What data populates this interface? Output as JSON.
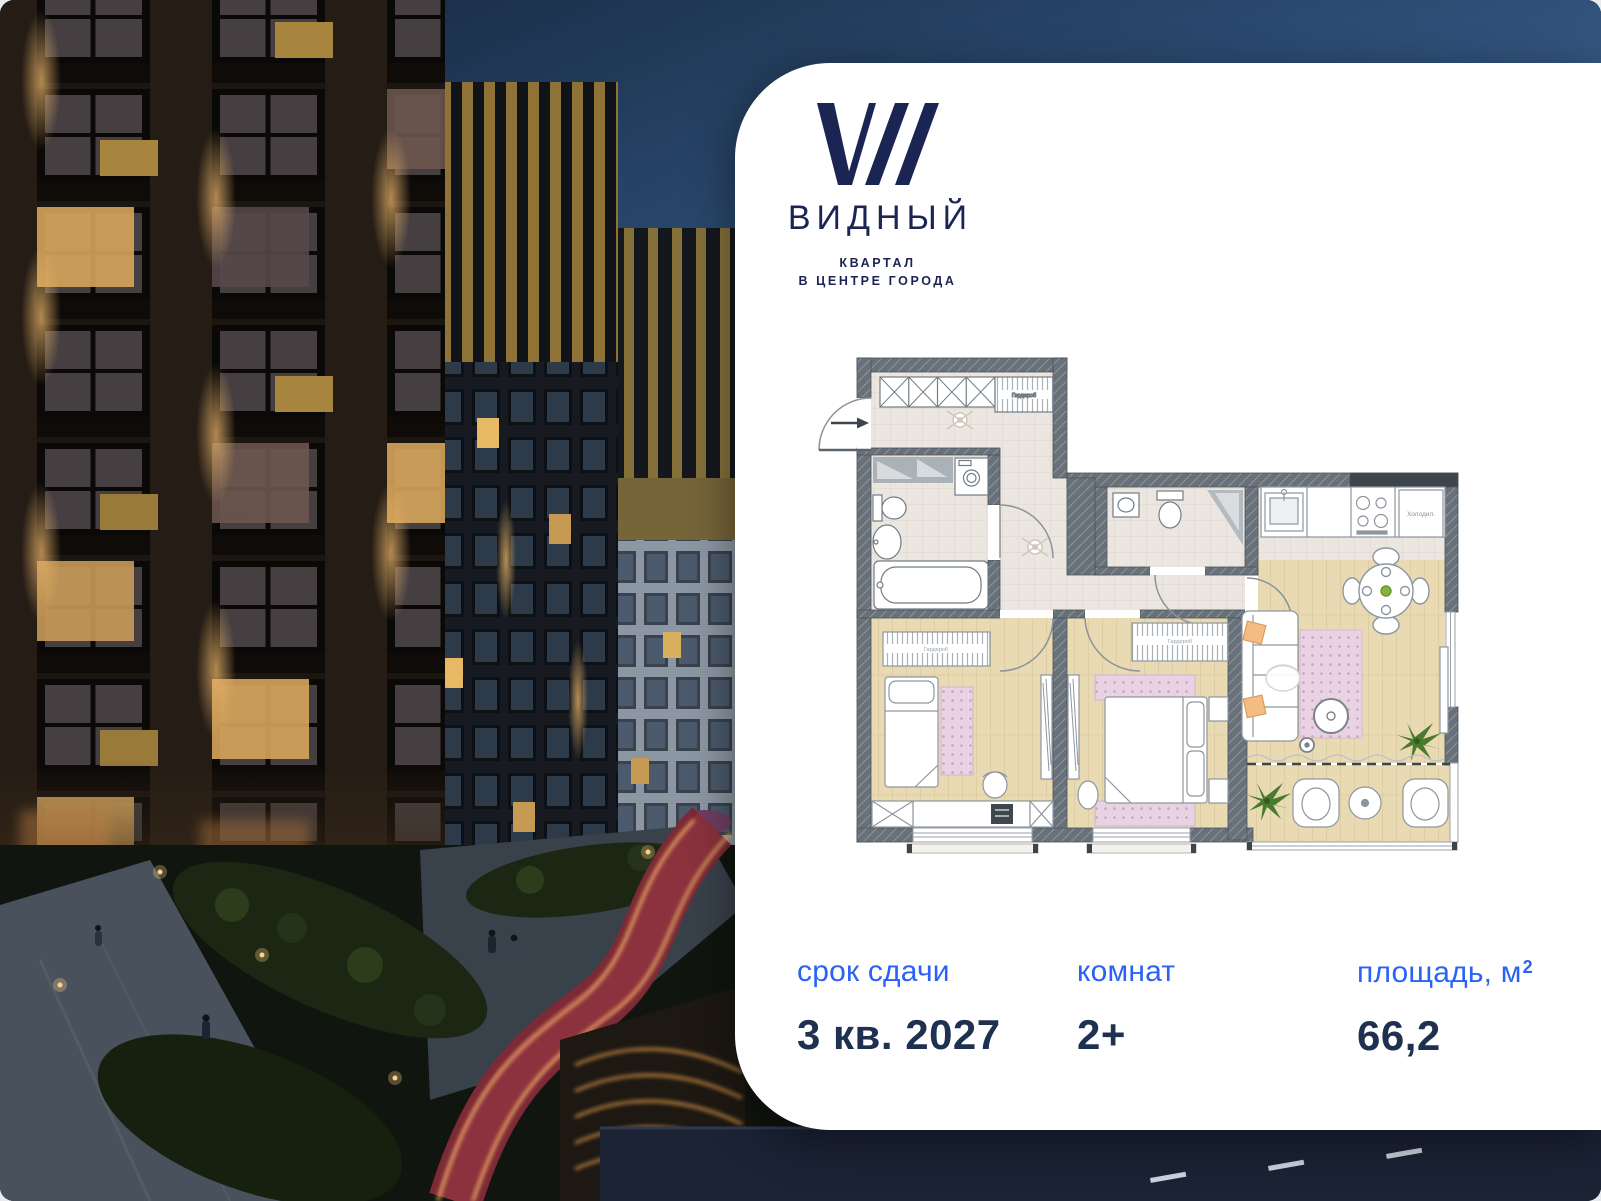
{
  "brand": {
    "name": "ВИДНЫЙ",
    "tagline1": "КВАРТАЛ",
    "tagline2": "В ЦЕНТРЕ ГОРОДА"
  },
  "stats": {
    "deadline_label": "срок сдачи",
    "deadline_value": "3 кв. 2027",
    "rooms_label": "комнат",
    "rooms_value": "2+",
    "area_label": "площадь, м",
    "area_sup": "2",
    "area_value": "66,2"
  },
  "floorplan": {
    "fridge_label": "Холодил.",
    "closet_label": "Гардероб",
    "wardrobe1_label": "Гардероб",
    "wardrobe2_label": "Гардероб"
  },
  "colors": {
    "accent_blue": "#2a63f4",
    "value_navy": "#1e3151",
    "logo_navy": "#1b2553",
    "card_bg": "#ffffff",
    "sky_top": "#14243a",
    "path_red": "#7c2a35",
    "led_amber": "#ffb45e"
  }
}
